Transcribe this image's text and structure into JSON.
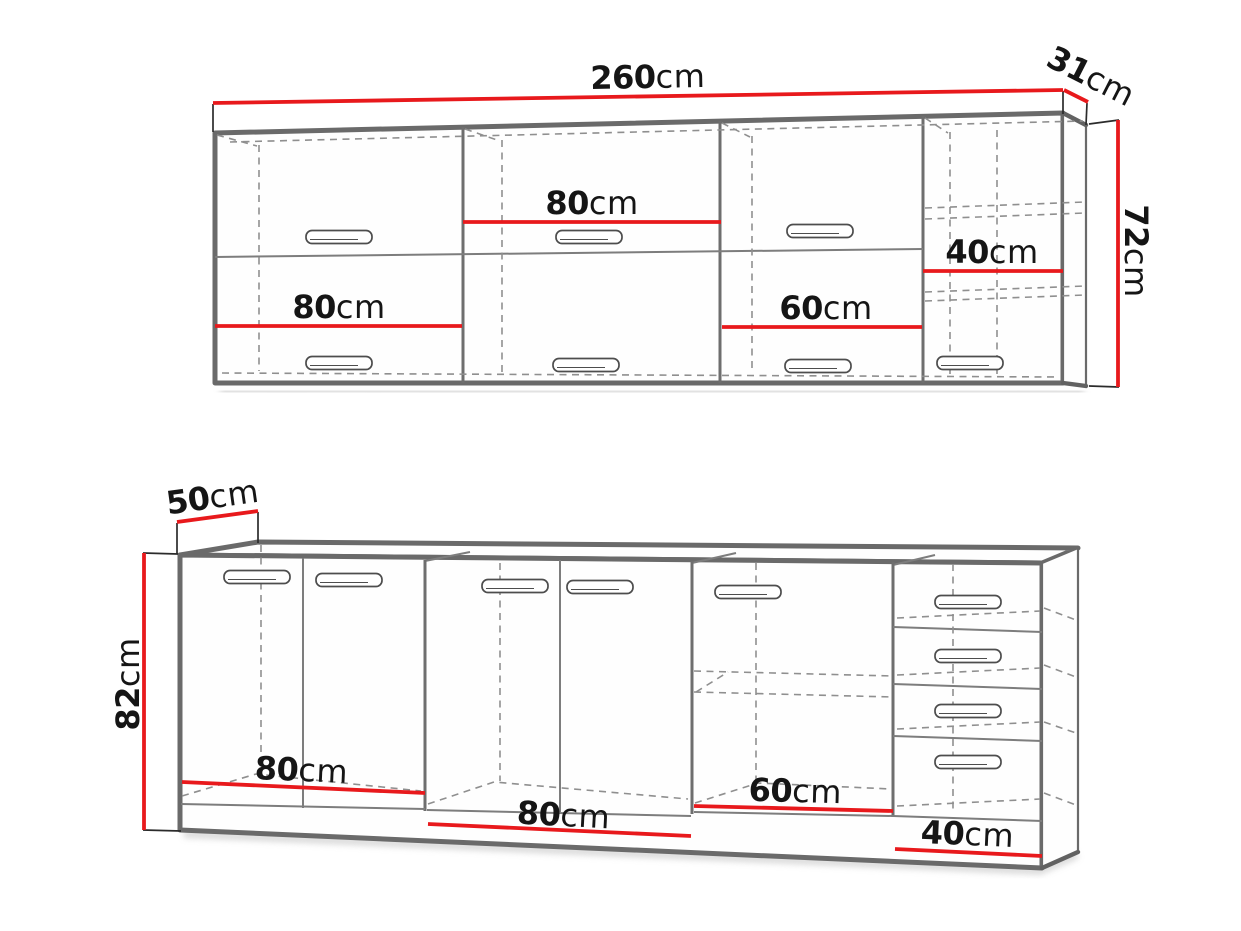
{
  "colors": {
    "dimension_red": "#e8191c",
    "edge_gray": "#6a6a6a",
    "dash_gray": "#8f8f8f",
    "text_black": "#151515"
  },
  "wall_cabinets": {
    "total_width": {
      "value": "260",
      "unit": "cm"
    },
    "depth": {
      "value": "31",
      "unit": "cm"
    },
    "height": {
      "value": "72",
      "unit": "cm"
    },
    "sections": [
      {
        "width": {
          "value": "80",
          "unit": "cm"
        }
      },
      {
        "width": {
          "value": "80",
          "unit": "cm"
        }
      },
      {
        "width": {
          "value": "60",
          "unit": "cm"
        }
      },
      {
        "width": {
          "value": "40",
          "unit": "cm"
        }
      }
    ]
  },
  "base_cabinets": {
    "depth": {
      "value": "50",
      "unit": "cm"
    },
    "height": {
      "value": "82",
      "unit": "cm"
    },
    "sections": [
      {
        "width": {
          "value": "80",
          "unit": "cm"
        }
      },
      {
        "width": {
          "value": "80",
          "unit": "cm"
        }
      },
      {
        "width": {
          "value": "60",
          "unit": "cm"
        }
      },
      {
        "width": {
          "value": "40",
          "unit": "cm"
        }
      }
    ]
  }
}
